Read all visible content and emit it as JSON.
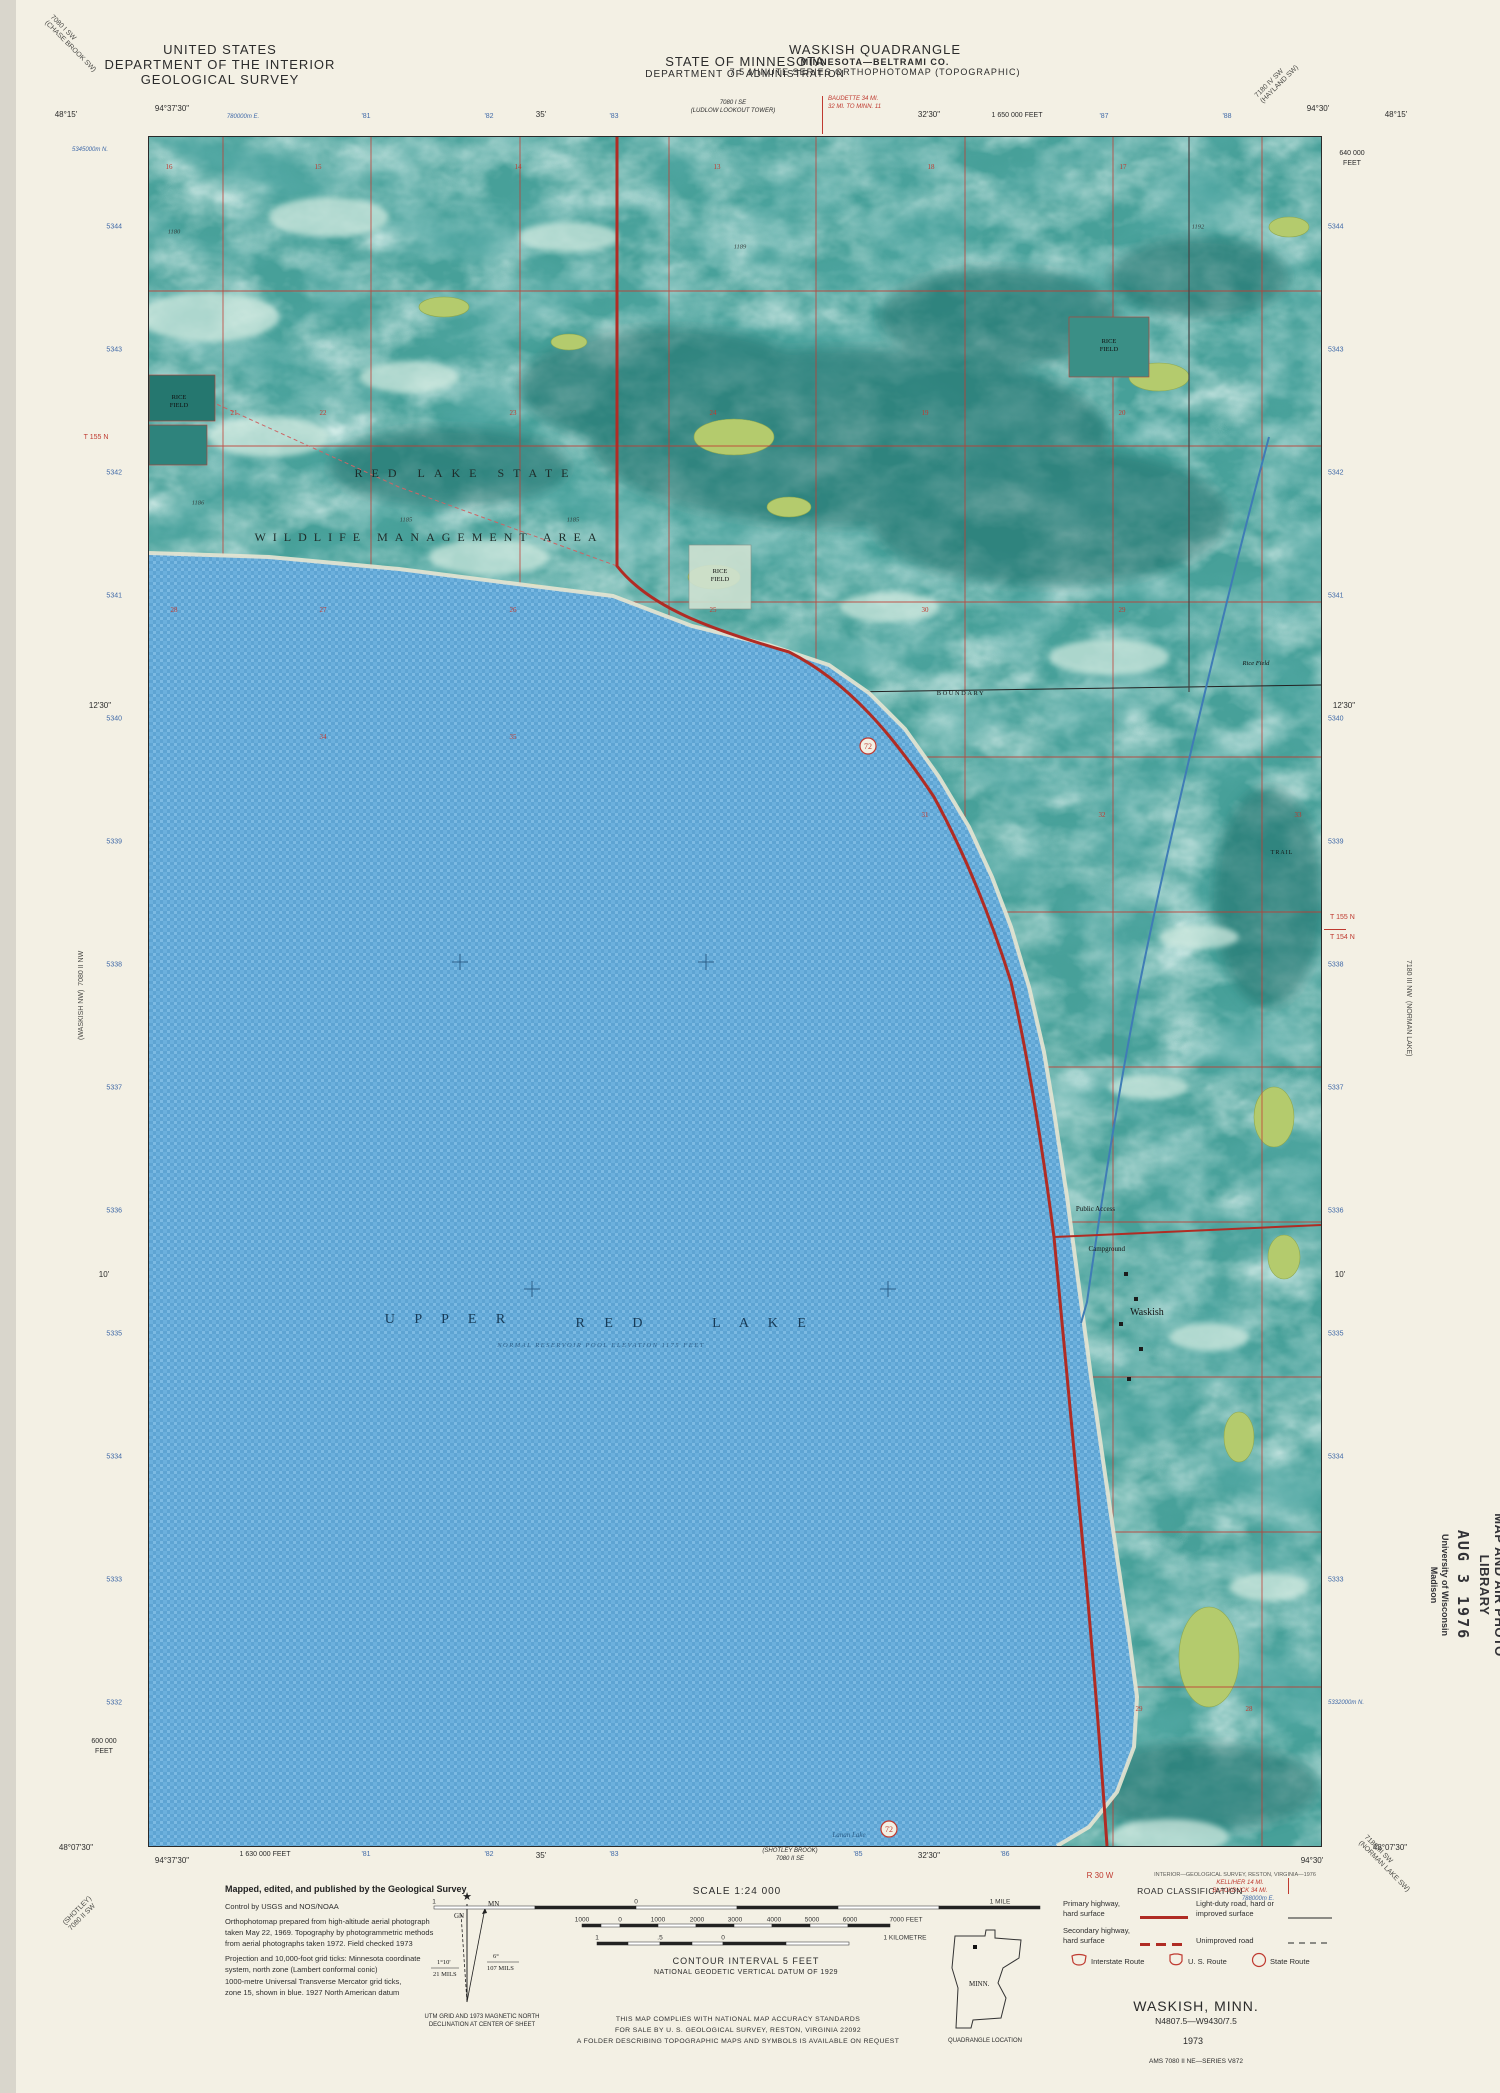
{
  "header": {
    "us1": "UNITED STATES",
    "us2": "DEPARTMENT OF THE INTERIOR",
    "us3": "GEOLOGICAL SURVEY",
    "state1": "STATE OF MINNESOTA",
    "state2": "DEPARTMENT OF ADMINISTRATION",
    "quad1": "WASKISH QUADRANGLE",
    "quad2": "MINNESOTA—BELTRAMI CO.",
    "quad3": "7.5 MINUTE SERIES ORTHOPHOTOMAP (TOPOGRAPHIC)",
    "tl1": "7080 I SW",
    "tl2": "(CHASE BROOK SW)",
    "tr1": "7180 IV SW",
    "tr2": "(HAYLAND SW)"
  },
  "edges": {
    "top": {
      "lat_l": "48°15'",
      "lon_l": "94°37'30\"",
      "utm_e": "780000m E.",
      "t81": "'81",
      "t82": "'82",
      "t35": "35'",
      "t83": "'83",
      "adj1": "7080 I SE",
      "adj2": "(LUDLOW LOOKOUT TOWER)",
      "dest1": "BAUDETTE 34 MI.",
      "dest2": "32 MI. TO MINN. 11",
      "t3230": "32'30\"",
      "feet": "1 650 000 FEET",
      "t87": "'87",
      "t88": "'88",
      "lon_r": "94°30'",
      "lat_r": "48°15'"
    },
    "left": {
      "utm_n": "5345000m N.",
      "nums": [
        "5344",
        "5343",
        "5342",
        "5341",
        "5340",
        "5339",
        "5338",
        "5337",
        "5336",
        "5335",
        "5334",
        "5333",
        "5332"
      ],
      "t1230": "12'30\"",
      "t10": "10'",
      "feet1": "600 000",
      "feet2": "FEET",
      "township": "T 155 N",
      "adj1": "(WASKISH NW)",
      "adj2": "7080 II NW",
      "bl1": "(SHOTLEY)",
      "bl2": "7080 II SW"
    },
    "right": {
      "feet1": "640 000",
      "feet2": "FEET",
      "nums": [
        "5344",
        "5343",
        "5342",
        "5341",
        "5340",
        "5339",
        "5338",
        "5337",
        "5336",
        "5335",
        "5334",
        "5333"
      ],
      "utm_n": "5332000m N.",
      "t1230": "12'30\"",
      "t10": "10'",
      "town1": "T 155 N",
      "town2": "T 154 N",
      "adj1": "(NORMAN LAKE)",
      "adj2": "7180 III NW",
      "br1": "7180 III SW",
      "br2": "(NORMAN LAKE SW)"
    },
    "bottom": {
      "lat_l": "48°07'30\"",
      "lon_l": "94°37'30\"",
      "feet": "1 630 000 FEET",
      "t81": "'81",
      "t82": "'82",
      "t35": "35'",
      "t83": "'83",
      "adj1": "(SHOTLEY BROOK)",
      "adj2": "7080 II SE",
      "t85": "'85",
      "t3230": "32'30\"",
      "t86": "'86",
      "range": "R 30 W",
      "credit": "INTERIOR—GEOLOGICAL SURVEY, RESTON, VIRGINIA—1976",
      "dest1": "KELLIHER 14 MI.",
      "dest2": "BLACKDUCK 34 MI.",
      "utm_e": "788000m E.",
      "lon_r": "94°30'",
      "lat_r": "48°07'30\""
    }
  },
  "map": {
    "labels": {
      "area1": "RED LAKE STATE",
      "area2": "WILDLIFE MANAGEMENT AREA",
      "up": "U P P E R",
      "red": "R E D",
      "lake": "L A K E",
      "note": "NORMAL RESERVOIR POOL ELEVATION 1175 FEET",
      "town": "Waskish",
      "access": "Public Access",
      "camp": "Campground",
      "boundary": "BOUNDARY",
      "rice_top": "RICE",
      "rice_bot": "FIELD",
      "rice_small": "Rice Field",
      "trail": "TRAIL",
      "lanan": "Lanan Lake",
      "route": "72"
    },
    "sections": {
      "row1": [
        "16",
        "15",
        "14",
        "13",
        "18",
        "17"
      ],
      "row2": [
        "21",
        "22",
        "23",
        "24",
        "19",
        "20"
      ],
      "row3": [
        "28",
        "27",
        "26",
        "25",
        "30",
        "29"
      ],
      "row4a": [
        "34",
        "35"
      ],
      "row4b": [
        "31",
        "32",
        "33"
      ],
      "row5": [
        "29",
        "28"
      ]
    },
    "elevations": [
      "1180",
      "1186",
      "1185",
      "1185",
      "1189",
      "1192"
    ]
  },
  "collar": {
    "credits": {
      "title": "Mapped, edited, and published by the Geological Survey",
      "lines": [
        "Control by USGS and NOS/NOAA",
        "Orthophotomap prepared from high-altitude aerial photograph",
        "taken May 22, 1969.  Topography by photogrammetric methods",
        "from aerial photographs taken 1972.  Field checked 1973",
        "Projection and 10,000-foot grid ticks: Minnesota coordinate",
        "system, north zone (Lambert conformal conic)",
        "1000-metre Universal Transverse Mercator grid ticks,",
        "zone 15, shown in blue.  1927 North American datum"
      ]
    },
    "decl": {
      "gn": "GN",
      "mn": "MN",
      "ld": "1°10'",
      "lm": "21 MILS",
      "rd": "6°",
      "rm": "107 MILS",
      "n1": "UTM GRID AND 1973 MAGNETIC NORTH",
      "n2": "DECLINATION AT CENTER OF SHEET"
    },
    "scale": {
      "title": "SCALE 1:24 000",
      "mile": [
        "1",
        "0",
        "1 MILE"
      ],
      "feet": [
        "1000",
        "0",
        "1000",
        "2000",
        "3000",
        "4000",
        "5000",
        "6000",
        "7000 FEET"
      ],
      "km": [
        "1",
        ".5",
        "0",
        "1 KILOMETRE"
      ]
    },
    "contour1": "CONTOUR INTERVAL 5 FEET",
    "contour2": "NATIONAL GEODETIC VERTICAL DATUM OF 1929",
    "accuracy": [
      "THIS MAP COMPLIES WITH NATIONAL MAP ACCURACY STANDARDS",
      "FOR SALE BY U. S. GEOLOGICAL SURVEY, RESTON, VIRGINIA 22092",
      "A FOLDER DESCRIBING TOPOGRAPHIC MAPS AND SYMBOLS IS AVAILABLE ON REQUEST"
    ],
    "loc": {
      "state": "MINN.",
      "caption": "QUADRANGLE LOCATION"
    },
    "road": {
      "title": "ROAD CLASSIFICATION",
      "p1": "Primary highway,",
      "p2": "hard surface",
      "l1": "Light-duty road, hard or",
      "l2": "improved surface",
      "s1": "Secondary highway,",
      "s2": "hard surface",
      "u1": "Unimproved road",
      "i": "Interstate Route",
      "us": "U. S. Route",
      "st": "State Route"
    },
    "tb": {
      "name": "WASKISH, MINN.",
      "id": "N4807.5—W9430/7.5",
      "year": "1973",
      "series": "AMS 7080 II NE—SERIES V872"
    }
  },
  "stamp": {
    "l1": "MAP AND AIR PHOTO",
    "l2": "LIBRARY",
    "date": "AUG 3  1976",
    "o1": "University of Wisconsin",
    "o2": "Madison"
  },
  "colors": {
    "land": "#47a099",
    "lake": "#63a8d6",
    "grid_red": "#c23a30",
    "highway": "#b02c24",
    "vegetation": "#b4cb6d",
    "paper": "#f3f0e4"
  }
}
